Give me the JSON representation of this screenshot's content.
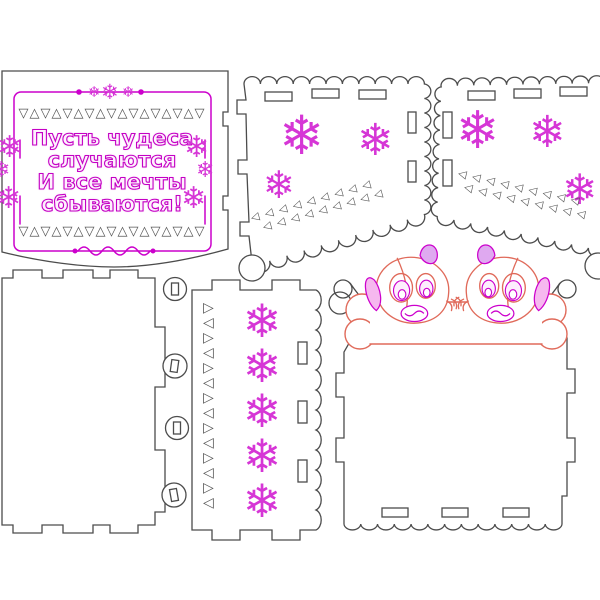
{
  "message": {
    "lines": [
      "Пусть чудеса",
      "случаются",
      "И все мечты",
      "сбываются!"
    ]
  },
  "ornaments": {
    "snowflake": "❄",
    "snowflake_column": "❄❄❄❄❄",
    "triangle_row": "▽△▽△▽△▽△▽△▽△▽△▽△▽",
    "triangle_band_row": "◁◁◁◁◁◁◁◁◁",
    "zigzag_column": "▷◁▷◁▷◁▷◁▷◁▷◁▷◁"
  },
  "colors": {
    "outline": "#4c4c4c",
    "trigray": "#565656",
    "magenta": "#cc00cc",
    "snowpink": "#d636d6",
    "dogred": "#e06a5a",
    "earpink": "#f6b8ef",
    "earpurple": "#dfa9f0"
  }
}
